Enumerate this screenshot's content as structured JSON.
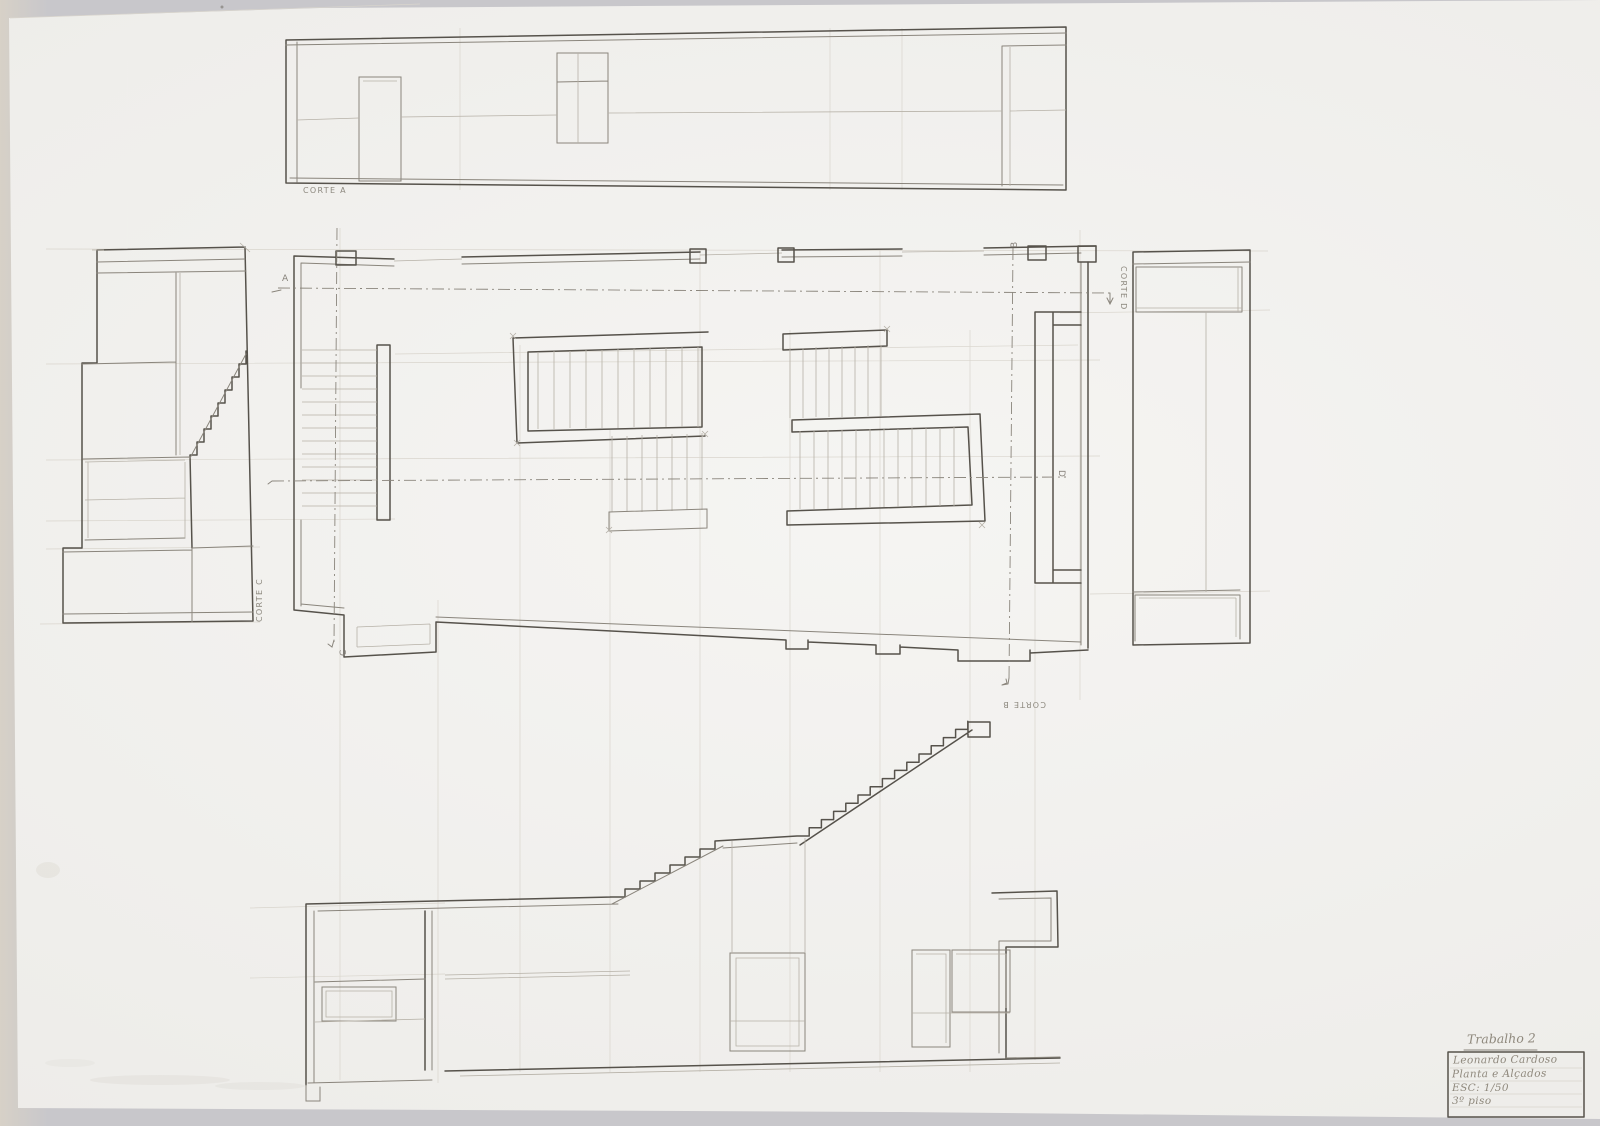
{
  "colors": {
    "bg": "#c8c7cb",
    "bg-warm": "#d7d1c7",
    "paper": "#f2f1ee",
    "pencil-dark": "#56524b",
    "pencil-med": "#8a857c",
    "pencil-light": "#b6b1a7",
    "pencil-faint": "#d9d5cd",
    "hand": "#8f897d"
  },
  "labels": {
    "corte_a": "CORTE A",
    "corte_b": "CORTE B",
    "corte_c": "CORTE C",
    "corte_d": "CORTE D"
  },
  "markers": {
    "a": "A",
    "b": "B",
    "c": "C",
    "d": "D"
  },
  "title_block": {
    "assignment": "Trabalho 2",
    "author": "Leonardo Cardoso",
    "subject": "Planta e Alçados",
    "scale": "ESC: 1/50",
    "floor": "3º piso"
  }
}
